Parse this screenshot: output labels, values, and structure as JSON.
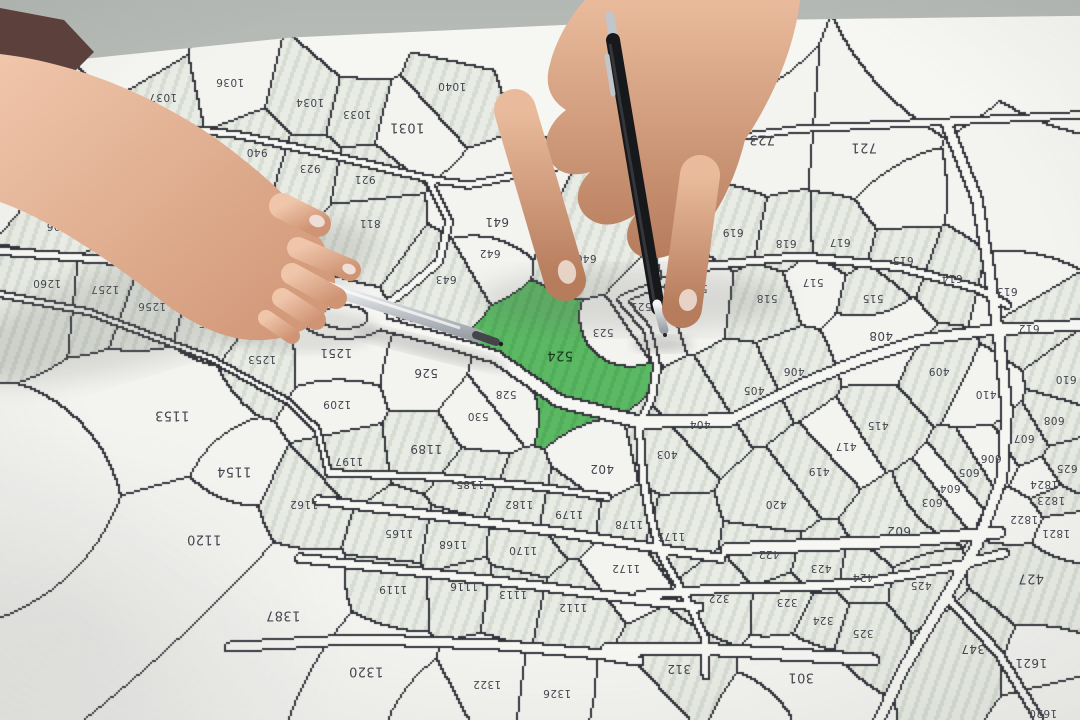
{
  "scene": {
    "description": "Top-down photo of a cadastral map on a table. A woman's hand (left, dark sleeve) holds a silver ballpoint pen and a man's hand (top) holds a black pen; both pen tips point at parcel 524, which is highlighted green. All parcel numbers are printed upside-down (map faces the opposite side of the table).",
    "surface": "cadastral parcel map on light table",
    "highlighted_parcel": "524",
    "map_text_orientation": "rotated-180",
    "objects": [
      "cadastral-parcel-map",
      "green-highlighted-parcel-524",
      "left-hand-with-silver-pen",
      "right-hand-with-black-pen",
      "dark-sleeve"
    ],
    "colors": {
      "highlight_green": "#57b45f",
      "paper": "#f6f6f3",
      "parcel_white": "#f3f3f0",
      "parcel_hatch_light": "#e9ece5",
      "parcel_hatch_stripe": "#d6dbd3",
      "boundary_line": "#33343b",
      "label_text": "#43444d",
      "table": "#b4b8b4",
      "skin_left_hand": "#eec3a8",
      "skin_right_hand": "#e2b294",
      "sleeve": "#5c403c",
      "pen_silver": "#c9ccd0",
      "pen_black": "#17181c"
    }
  },
  "map": {
    "label_rotation_deg": 180,
    "parcels": [
      {
        "n": "1037",
        "x": 163,
        "y": 97,
        "f": "h"
      },
      {
        "n": "1036",
        "x": 230,
        "y": 82,
        "f": "w"
      },
      {
        "n": "1034",
        "x": 310,
        "y": 102,
        "f": "h"
      },
      {
        "n": "1033",
        "x": 357,
        "y": 114,
        "f": "h"
      },
      {
        "n": "1031",
        "x": 407,
        "y": 127,
        "f": "w",
        "s": 13
      },
      {
        "n": "1040",
        "x": 452,
        "y": 86,
        "f": "h"
      },
      {
        "n": "940",
        "x": 257,
        "y": 152,
        "f": "h"
      },
      {
        "n": "923",
        "x": 310,
        "y": 168,
        "f": "h"
      },
      {
        "n": "921",
        "x": 365,
        "y": 179,
        "f": "h"
      },
      {
        "n": "811",
        "x": 370,
        "y": 223,
        "f": "h"
      },
      {
        "n": "806",
        "x": 57,
        "y": 226,
        "f": "h"
      },
      {
        "n": "723",
        "x": 762,
        "y": 139,
        "f": "w",
        "s": 13,
        "wt": 1.2
      },
      {
        "n": "721",
        "x": 864,
        "y": 147,
        "f": "w",
        "s": 13,
        "wt": 1.2
      },
      {
        "n": "641",
        "x": 497,
        "y": 222,
        "f": "w",
        "s": 12,
        "wt": 1.2
      },
      {
        "n": "642",
        "x": 490,
        "y": 253,
        "f": "w"
      },
      {
        "n": "643",
        "x": 446,
        "y": 279,
        "f": "h"
      },
      {
        "n": "640",
        "x": 586,
        "y": 258,
        "f": "h",
        "wt": 1.15
      },
      {
        "n": "619",
        "x": 733,
        "y": 232,
        "f": "h"
      },
      {
        "n": "618",
        "x": 786,
        "y": 243,
        "f": "h"
      },
      {
        "n": "617",
        "x": 840,
        "y": 242,
        "f": "h"
      },
      {
        "n": "615",
        "x": 903,
        "y": 260,
        "f": "h"
      },
      {
        "n": "614",
        "x": 952,
        "y": 278,
        "f": "h"
      },
      {
        "n": "613",
        "x": 1007,
        "y": 291,
        "f": "w"
      },
      {
        "n": "612",
        "x": 1029,
        "y": 328,
        "f": "h"
      },
      {
        "n": "610",
        "x": 1066,
        "y": 379,
        "f": "h"
      },
      {
        "n": "608",
        "x": 1054,
        "y": 420,
        "f": "h"
      },
      {
        "n": "607",
        "x": 1024,
        "y": 438,
        "f": "h"
      },
      {
        "n": "606",
        "x": 991,
        "y": 458,
        "f": "w"
      },
      {
        "n": "605",
        "x": 969,
        "y": 472,
        "f": "h"
      },
      {
        "n": "604",
        "x": 950,
        "y": 488,
        "f": "w"
      },
      {
        "n": "603",
        "x": 932,
        "y": 502,
        "f": "h"
      },
      {
        "n": "625",
        "x": 1067,
        "y": 468,
        "f": "h"
      },
      {
        "n": "602",
        "x": 899,
        "y": 531,
        "f": "h",
        "s": 12,
        "wt": 1.2
      },
      {
        "n": "521",
        "x": 641,
        "y": 306,
        "f": "w"
      },
      {
        "n": "519",
        "x": 697,
        "y": 288,
        "f": "w"
      },
      {
        "n": "518",
        "x": 767,
        "y": 298,
        "f": "h"
      },
      {
        "n": "517",
        "x": 813,
        "y": 282,
        "f": "w"
      },
      {
        "n": "515",
        "x": 873,
        "y": 298,
        "f": "h"
      },
      {
        "n": "523",
        "x": 603,
        "y": 332,
        "f": "w"
      },
      {
        "n": "524",
        "x": 560,
        "y": 355,
        "f": "g",
        "s": 13,
        "wt": 1.6
      },
      {
        "n": "526",
        "x": 426,
        "y": 373,
        "f": "w",
        "s": 12
      },
      {
        "n": "528",
        "x": 506,
        "y": 394,
        "f": "w"
      },
      {
        "n": "530",
        "x": 478,
        "y": 416,
        "f": "w"
      },
      {
        "n": "408",
        "x": 881,
        "y": 336,
        "f": "w",
        "s": 12,
        "wt": 1.25
      },
      {
        "n": "406",
        "x": 794,
        "y": 371,
        "f": "h"
      },
      {
        "n": "405",
        "x": 754,
        "y": 390,
        "f": "h"
      },
      {
        "n": "404",
        "x": 700,
        "y": 424,
        "f": "h"
      },
      {
        "n": "409",
        "x": 939,
        "y": 371,
        "f": "h"
      },
      {
        "n": "410",
        "x": 986,
        "y": 394,
        "f": "w"
      },
      {
        "n": "415",
        "x": 878,
        "y": 425,
        "f": "h"
      },
      {
        "n": "417",
        "x": 846,
        "y": 446,
        "f": "w"
      },
      {
        "n": "419",
        "x": 819,
        "y": 471,
        "f": "h"
      },
      {
        "n": "420",
        "x": 776,
        "y": 504,
        "f": "h"
      },
      {
        "n": "403",
        "x": 667,
        "y": 454,
        "f": "h"
      },
      {
        "n": "402",
        "x": 602,
        "y": 469,
        "f": "w",
        "s": 12
      },
      {
        "n": "1260",
        "x": 47,
        "y": 283,
        "f": "h"
      },
      {
        "n": "1257",
        "x": 105,
        "y": 289,
        "f": "h"
      },
      {
        "n": "1256",
        "x": 152,
        "y": 306,
        "f": "h"
      },
      {
        "n": "1255",
        "x": 212,
        "y": 323,
        "f": "h"
      },
      {
        "n": "1253",
        "x": 262,
        "y": 359,
        "f": "h"
      },
      {
        "n": "1251",
        "x": 336,
        "y": 353,
        "f": "w",
        "s": 12,
        "wt": 1.2
      },
      {
        "n": "1209",
        "x": 337,
        "y": 404,
        "f": "w"
      },
      {
        "n": "1153",
        "x": 172,
        "y": 415,
        "f": "w",
        "s": 13,
        "wt": 1.5
      },
      {
        "n": "1154",
        "x": 234,
        "y": 471,
        "f": "w",
        "s": 13
      },
      {
        "n": "1120",
        "x": 204,
        "y": 539,
        "f": "w",
        "s": 13,
        "wt": 1.45
      },
      {
        "n": "1162",
        "x": 304,
        "y": 504,
        "f": "h"
      },
      {
        "n": "1197",
        "x": 349,
        "y": 461,
        "f": "h"
      },
      {
        "n": "1189",
        "x": 426,
        "y": 449,
        "f": "h",
        "s": 12
      },
      {
        "n": "1185",
        "x": 470,
        "y": 484,
        "f": "h"
      },
      {
        "n": "1182",
        "x": 519,
        "y": 504,
        "f": "h"
      },
      {
        "n": "1179",
        "x": 569,
        "y": 514,
        "f": "h"
      },
      {
        "n": "1178",
        "x": 629,
        "y": 524,
        "f": "h"
      },
      {
        "n": "1175",
        "x": 671,
        "y": 536,
        "f": "h"
      },
      {
        "n": "1172",
        "x": 626,
        "y": 568,
        "f": "w"
      },
      {
        "n": "1165",
        "x": 399,
        "y": 533,
        "f": "h"
      },
      {
        "n": "1168",
        "x": 453,
        "y": 544,
        "f": "h"
      },
      {
        "n": "1170",
        "x": 523,
        "y": 550,
        "f": "h"
      },
      {
        "n": "1119",
        "x": 393,
        "y": 589,
        "f": "h"
      },
      {
        "n": "1116",
        "x": 464,
        "y": 586,
        "f": "h"
      },
      {
        "n": "1113",
        "x": 513,
        "y": 594,
        "f": "h"
      },
      {
        "n": "1112",
        "x": 573,
        "y": 607,
        "f": "h"
      },
      {
        "n": "1387",
        "x": 283,
        "y": 615,
        "f": "w",
        "s": 13,
        "wt": 1.5
      },
      {
        "n": "1320",
        "x": 366,
        "y": 671,
        "f": "w",
        "s": 13,
        "wt": 1.3
      },
      {
        "n": "1322",
        "x": 487,
        "y": 684,
        "f": "w"
      },
      {
        "n": "1326",
        "x": 557,
        "y": 693,
        "f": "w"
      },
      {
        "n": "312",
        "x": 679,
        "y": 669,
        "f": "h",
        "s": 12,
        "wt": 1.2
      },
      {
        "n": "301",
        "x": 801,
        "y": 677,
        "f": "w",
        "s": 13,
        "wt": 1.3
      },
      {
        "n": "322",
        "x": 719,
        "y": 598,
        "f": "h"
      },
      {
        "n": "323",
        "x": 787,
        "y": 602,
        "f": "h"
      },
      {
        "n": "324",
        "x": 823,
        "y": 620,
        "f": "h"
      },
      {
        "n": "325",
        "x": 863,
        "y": 633,
        "f": "h"
      },
      {
        "n": "347",
        "x": 973,
        "y": 649,
        "f": "h",
        "s": 12,
        "wt": 1.25
      },
      {
        "n": "422",
        "x": 769,
        "y": 554,
        "f": "h"
      },
      {
        "n": "423",
        "x": 821,
        "y": 568,
        "f": "h"
      },
      {
        "n": "424",
        "x": 863,
        "y": 577,
        "f": "h"
      },
      {
        "n": "425",
        "x": 921,
        "y": 585,
        "f": "h"
      },
      {
        "n": "427",
        "x": 1031,
        "y": 578,
        "f": "h",
        "s": 13,
        "wt": 1.3
      },
      {
        "n": "1824",
        "x": 1044,
        "y": 484,
        "f": "w"
      },
      {
        "n": "1823",
        "x": 1051,
        "y": 500,
        "f": "h"
      },
      {
        "n": "1822",
        "x": 1024,
        "y": 519,
        "f": "w"
      },
      {
        "n": "1821",
        "x": 1056,
        "y": 533,
        "f": "w"
      },
      {
        "n": "1621",
        "x": 1031,
        "y": 663,
        "f": "w",
        "s": 12
      },
      {
        "n": "1620",
        "x": 1043,
        "y": 713,
        "f": "w"
      }
    ]
  }
}
